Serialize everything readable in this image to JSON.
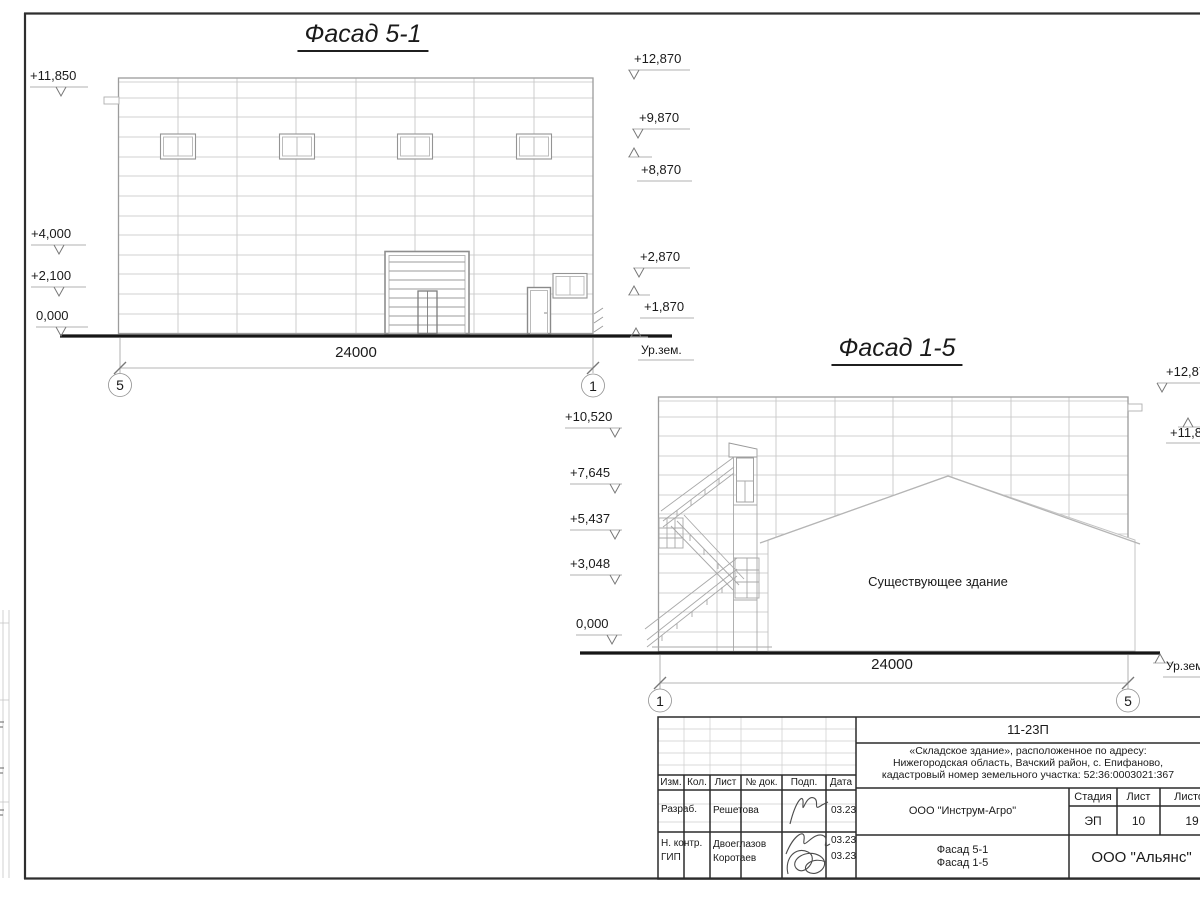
{
  "facade_5_1": {
    "title": "Фасад 5-1",
    "dimension_label": "24000",
    "axis_left": "5",
    "axis_right": "1",
    "ground_level_label": "Ур.зем.",
    "left_elevation_marks": [
      "+11,850",
      "+4,000",
      "+2,100",
      "0,000"
    ],
    "right_elevation_marks": [
      "+12,870",
      "+9,870",
      "+8,870",
      "+2,870",
      "+1,870"
    ]
  },
  "facade_1_5": {
    "title": "Фасад 1-5",
    "dimension_label": "24000",
    "axis_left": "1",
    "axis_right": "5",
    "ground_level_label": "Ур.зем.",
    "existing_building_label": "Существующее здание",
    "left_elevation_marks": [
      "+10,520",
      "+7,645",
      "+5,437",
      "+3,048",
      "0,000"
    ],
    "right_elevation_marks": [
      "+12,870",
      "+11,850"
    ]
  },
  "title_block": {
    "doc_code": "11-23П",
    "project_description_lines": [
      "«Складское здание», расположенное по адресу:",
      "Нижегородская область, Вачский район, с. Епифаново,",
      "кадастровый номер земельного участка: 52:36:0003021:367"
    ],
    "client": "ООО \"Инструм-Агро\"",
    "contractor": "ООО \"Альянс\"",
    "sheet_content_lines": [
      "Фасад 5-1",
      "Фасад 1-5"
    ],
    "stage_header": "Стадия",
    "sheet_header": "Лист",
    "sheets_header": "Листов",
    "stage": "ЭП",
    "sheet_number": "10",
    "sheets_total": "19",
    "revision_columns": [
      "Изм.",
      "Кол.",
      "Лист",
      "№ док.",
      "Подп.",
      "Дата"
    ],
    "signature_rows": [
      {
        "role": "Разраб.",
        "name": "Решетова",
        "date": "03.23"
      },
      {
        "role": "Н. контр.",
        "name": "Двоеглазов",
        "date": "03.23"
      },
      {
        "role": "ГИП",
        "name": "Коротаев",
        "date": "03.23"
      }
    ]
  }
}
